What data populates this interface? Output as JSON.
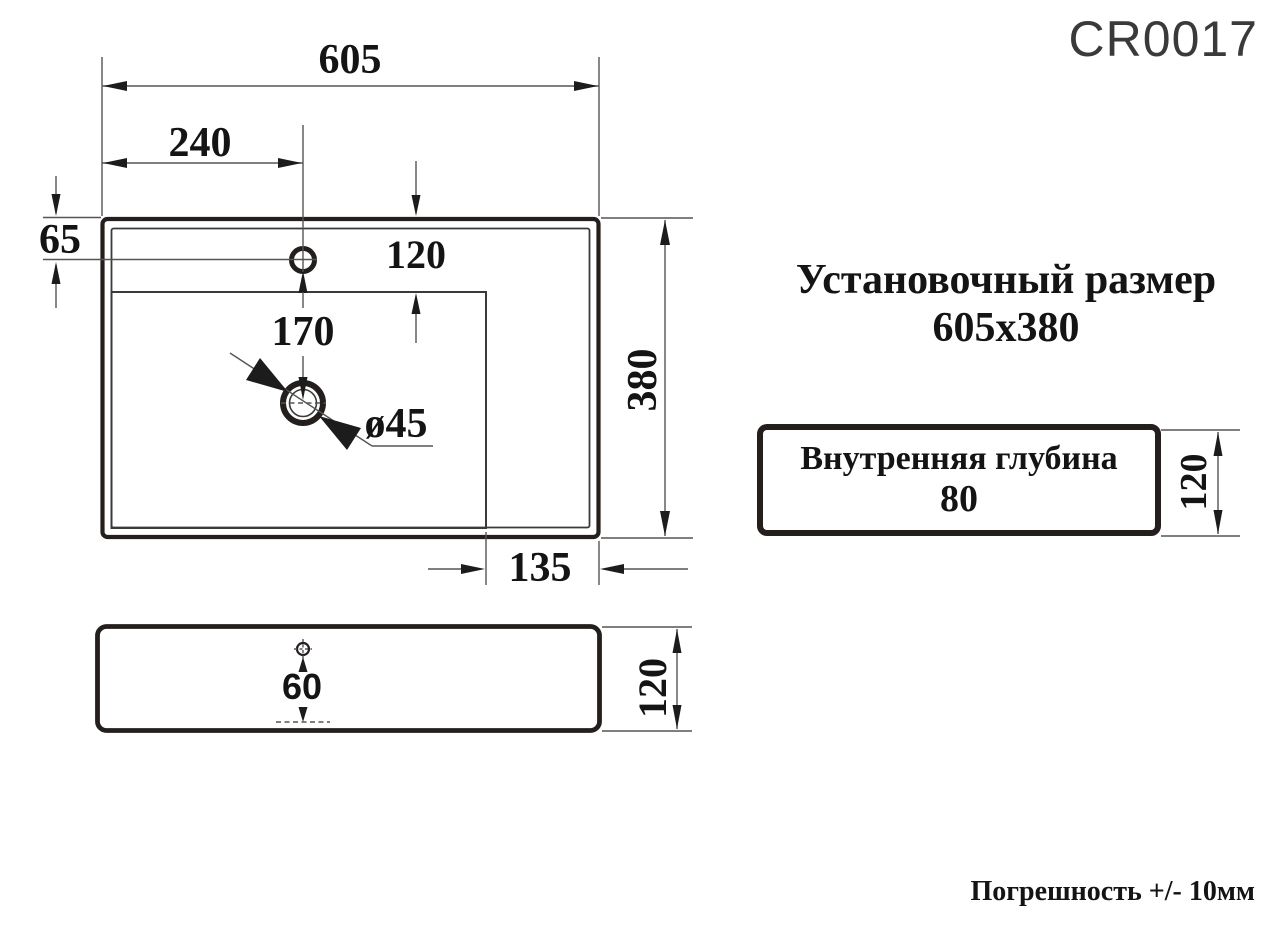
{
  "product_code": "CR0017",
  "install_note": {
    "line1": "Установочный размер",
    "line2": "605x380"
  },
  "inner_depth_box": {
    "line1": "Внутренняя глубина",
    "line2": "80",
    "height_dim": "120"
  },
  "tolerance_note": "Погрешность +/- 10мм",
  "plan_view": {
    "width": "605",
    "faucet_center_from_left": "240",
    "faucet_center_from_top": "65",
    "rim_to_basin": "120",
    "faucet_to_drain": "170",
    "drain_diameter": "ø45",
    "depth": "380",
    "basin_to_right_edge": "135"
  },
  "side_view": {
    "hole_to_bottom": "60",
    "height": "120"
  },
  "colors": {
    "line": "#555555",
    "med": "#3a3a3a",
    "heavy": "#241e1d",
    "arrow": "#1c1c1c",
    "text": "#141414",
    "code": "#3a3a3a"
  }
}
